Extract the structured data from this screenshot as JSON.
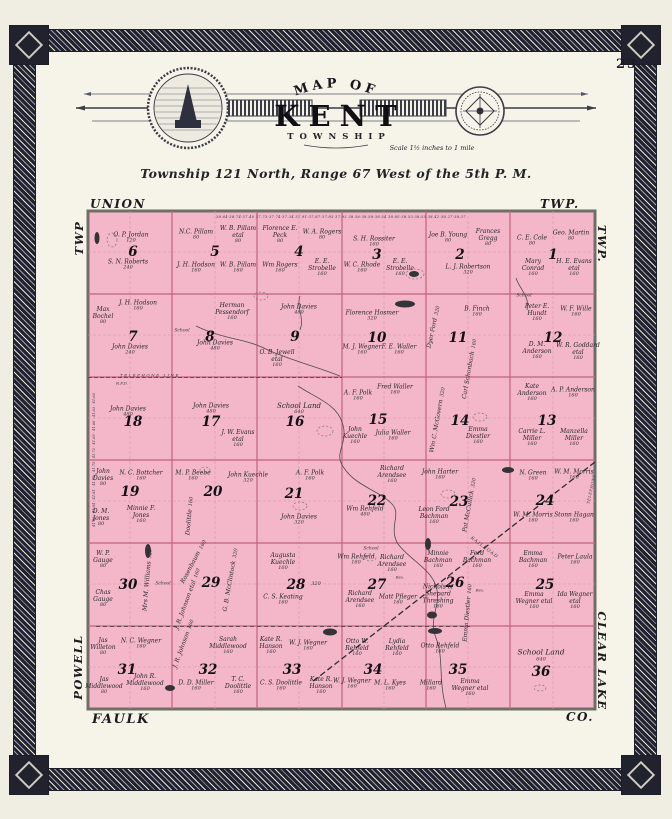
{
  "page": {
    "number": "23"
  },
  "banner": {
    "arc": "MAP OF",
    "title": "KENT",
    "subtitle": "TOWNSHIP",
    "scale": "Scale 1½ inches to 1 mile"
  },
  "township_line": "Township 121 North, Range 67 West of the 5th P. M.",
  "margins": {
    "top_left": "UNION",
    "top_right": "TWP.",
    "left_top": "TWP",
    "right_top": "TWP.",
    "left_bottom": "POWELL",
    "right_bottom": "CLEAR LAKE",
    "bottom_left": "FAULK",
    "bottom_right": "CO."
  },
  "colors": {
    "map_pink": "#f3b7c9",
    "grid_line": "#c2637c",
    "quarter_line": "#d795aa",
    "map_border": "#6f6f68",
    "paper": "#f6f3e9",
    "frame_dark": "#20222e"
  },
  "map": {
    "sections": [
      {
        "num": "6",
        "x": 133,
        "y": 252
      },
      {
        "num": "5",
        "x": 215,
        "y": 252
      },
      {
        "num": "4",
        "x": 299,
        "y": 252
      },
      {
        "num": "3",
        "x": 377,
        "y": 255
      },
      {
        "num": "2",
        "x": 460,
        "y": 255
      },
      {
        "num": "1",
        "x": 553,
        "y": 255
      },
      {
        "num": "7",
        "x": 133,
        "y": 337
      },
      {
        "num": "8",
        "x": 210,
        "y": 337
      },
      {
        "num": "9",
        "x": 295,
        "y": 337
      },
      {
        "num": "10",
        "x": 377,
        "y": 338
      },
      {
        "num": "11",
        "x": 458,
        "y": 338
      },
      {
        "num": "12",
        "x": 553,
        "y": 338
      },
      {
        "num": "18",
        "x": 133,
        "y": 422
      },
      {
        "num": "17",
        "x": 211,
        "y": 422
      },
      {
        "num": "16",
        "x": 295,
        "y": 422
      },
      {
        "num": "15",
        "x": 378,
        "y": 420
      },
      {
        "num": "14",
        "x": 460,
        "y": 421
      },
      {
        "num": "13",
        "x": 547,
        "y": 421
      },
      {
        "num": "19",
        "x": 130,
        "y": 492
      },
      {
        "num": "20",
        "x": 213,
        "y": 492
      },
      {
        "num": "21",
        "x": 294,
        "y": 494
      },
      {
        "num": "22",
        "x": 377,
        "y": 501
      },
      {
        "num": "23",
        "x": 459,
        "y": 502
      },
      {
        "num": "24",
        "x": 545,
        "y": 501
      },
      {
        "num": "30",
        "x": 128,
        "y": 585
      },
      {
        "num": "29",
        "x": 211,
        "y": 583
      },
      {
        "num": "28",
        "x": 296,
        "y": 585
      },
      {
        "num": "27",
        "x": 377,
        "y": 585
      },
      {
        "num": "26",
        "x": 455,
        "y": 583
      },
      {
        "num": "25",
        "x": 545,
        "y": 585
      },
      {
        "num": "31",
        "x": 127,
        "y": 670
      },
      {
        "num": "32",
        "x": 208,
        "y": 670
      },
      {
        "num": "33",
        "x": 292,
        "y": 670
      },
      {
        "num": "34",
        "x": 373,
        "y": 670
      },
      {
        "num": "35",
        "x": 458,
        "y": 670
      },
      {
        "num": "36",
        "x": 541,
        "y": 672
      }
    ],
    "parcels": [
      {
        "n": "O. P. Jordan",
        "a": "120",
        "x": 131,
        "y": 238,
        "w": 60
      },
      {
        "n": "S. N. Roberts",
        "a": "240",
        "x": 128,
        "y": 265,
        "w": 64
      },
      {
        "n": "N.C. Pillam",
        "a": "80",
        "x": 196,
        "y": 235,
        "w": 40
      },
      {
        "n": "W. B. Pillam etal",
        "a": "80",
        "x": 238,
        "y": 235,
        "w": 44
      },
      {
        "n": "J. H. Hodson",
        "a": "160",
        "x": 196,
        "y": 268,
        "w": 44
      },
      {
        "n": "W. B. Pillam",
        "a": "160",
        "x": 238,
        "y": 268,
        "w": 40
      },
      {
        "n": "Florence E. Peck",
        "a": "80",
        "x": 280,
        "y": 235,
        "w": 44
      },
      {
        "n": "W. A. Rogers",
        "a": "80",
        "x": 322,
        "y": 235,
        "w": 40
      },
      {
        "n": "Wm Rogers",
        "a": "160",
        "x": 280,
        "y": 268,
        "w": 40
      },
      {
        "n": "E. E. Strobelle",
        "a": "160",
        "x": 322,
        "y": 268,
        "w": 44
      },
      {
        "n": "S. H. Rossiter",
        "a": "160",
        "x": 374,
        "y": 242,
        "w": 64
      },
      {
        "n": "W. C. Rhode",
        "a": "160",
        "x": 362,
        "y": 268,
        "w": 40
      },
      {
        "n": "E. E. Strobelle",
        "a": "160",
        "x": 400,
        "y": 268,
        "w": 44
      },
      {
        "n": "Joe B. Young",
        "a": "80",
        "x": 448,
        "y": 238,
        "w": 40
      },
      {
        "n": "Frances Gregg",
        "a": "80",
        "x": 488,
        "y": 238,
        "w": 44
      },
      {
        "n": "L. J. Robertson",
        "a": "320",
        "x": 468,
        "y": 270,
        "w": 80
      },
      {
        "n": "C. E. Cole",
        "a": "80",
        "x": 532,
        "y": 241,
        "w": 40
      },
      {
        "n": "Geo. Martin",
        "a": "80",
        "x": 571,
        "y": 236,
        "w": 40
      },
      {
        "n": "Mary Conrad",
        "a": "160",
        "x": 533,
        "y": 268,
        "w": 40
      },
      {
        "n": "H. E. Evans etal",
        "a": "160",
        "x": 574,
        "y": 268,
        "w": 44
      },
      {
        "n": "Max Bochel",
        "a": "80",
        "x": 103,
        "y": 316,
        "w": 34
      },
      {
        "n": "J. H. Hodson",
        "a": "160",
        "x": 138,
        "y": 306,
        "w": 44
      },
      {
        "n": "John Davies",
        "a": "240",
        "x": 130,
        "y": 350,
        "w": 60
      },
      {
        "n": "Herman Pessendorf",
        "a": "160",
        "x": 232,
        "y": 312,
        "w": 60
      },
      {
        "n": "John Davies",
        "a": "480",
        "x": 215,
        "y": 346,
        "w": 60
      },
      {
        "n": "John Davies",
        "a": "480",
        "x": 299,
        "y": 310,
        "w": 60
      },
      {
        "n": "O. B. Jewell etal",
        "a": "160",
        "x": 277,
        "y": 359,
        "w": 40
      },
      {
        "n": "Florence Hosmer",
        "a": "320",
        "x": 372,
        "y": 316,
        "w": 80
      },
      {
        "n": "M. J. Wegner",
        "a": "160",
        "x": 362,
        "y": 350,
        "w": 40
      },
      {
        "n": "F. E. Waller",
        "a": "160",
        "x": 399,
        "y": 350,
        "w": 40
      },
      {
        "n": "Dyer Ford",
        "a": "320",
        "x": 434,
        "y": 327,
        "r": -78
      },
      {
        "n": "B. Finch",
        "a": "160",
        "x": 477,
        "y": 312,
        "w": 54
      },
      {
        "n": "Carl Schonbach",
        "a": "160",
        "x": 470,
        "y": 369,
        "r": -80
      },
      {
        "n": "Peter E. Hundt",
        "a": "160",
        "x": 537,
        "y": 313,
        "w": 44
      },
      {
        "n": "W. F. Wille",
        "a": "160",
        "x": 576,
        "y": 312,
        "w": 40
      },
      {
        "n": "D. M. Anderson",
        "a": "160",
        "x": 537,
        "y": 351,
        "w": 44
      },
      {
        "n": "W. R. Goddard etal",
        "a": "160",
        "x": 578,
        "y": 352,
        "w": 44
      },
      {
        "n": "John Davies",
        "a": "480",
        "x": 128,
        "y": 412,
        "w": 60
      },
      {
        "n": "John Davies",
        "a": "480",
        "x": 211,
        "y": 409,
        "w": 60
      },
      {
        "n": "J. W. Evans etal",
        "a": "160",
        "x": 238,
        "y": 439,
        "w": 44
      },
      {
        "n": "School Land",
        "a": "640",
        "x": 299,
        "y": 409,
        "w": 80,
        "fs": 7
      },
      {
        "n": "A. F. Polk",
        "a": "160",
        "x": 358,
        "y": 396,
        "w": 40
      },
      {
        "n": "Fred Waller",
        "a": "160",
        "x": 395,
        "y": 390,
        "w": 40
      },
      {
        "n": "John Kuechle",
        "a": "160",
        "x": 355,
        "y": 436,
        "w": 40
      },
      {
        "n": "Julia Waller",
        "a": "160",
        "x": 393,
        "y": 436,
        "w": 40
      },
      {
        "n": "Wm C. McGovern",
        "a": "320",
        "x": 438,
        "y": 420,
        "r": -80
      },
      {
        "n": "Emma Diestler",
        "a": "160",
        "x": 478,
        "y": 436,
        "w": 44
      },
      {
        "n": "Kate Anderson",
        "a": "160",
        "x": 532,
        "y": 393,
        "w": 44
      },
      {
        "n": "A. P. Anderson",
        "a": "160",
        "x": 573,
        "y": 393,
        "w": 44
      },
      {
        "n": "Carrie L. Miller",
        "a": "160",
        "x": 532,
        "y": 438,
        "w": 44
      },
      {
        "n": "Manzella Miller",
        "a": "160",
        "x": 574,
        "y": 438,
        "w": 44
      },
      {
        "n": "John Davies",
        "a": "80",
        "x": 103,
        "y": 478,
        "w": 34
      },
      {
        "n": "N. C. Bottcher",
        "a": "160",
        "x": 141,
        "y": 476,
        "w": 44
      },
      {
        "n": "D. M. Jones",
        "a": "80",
        "x": 101,
        "y": 518,
        "w": 34
      },
      {
        "n": "Minnie F. Jones",
        "a": "160",
        "x": 141,
        "y": 515,
        "w": 44
      },
      {
        "n": "M. P. Beebe",
        "a": "160",
        "x": 193,
        "y": 476,
        "w": 40
      },
      {
        "n": "John Kuechle",
        "a": "320",
        "x": 248,
        "y": 478,
        "w": 76
      },
      {
        "n": "Doolittle",
        "a": "160",
        "x": 190,
        "y": 516,
        "r": -85
      },
      {
        "n": "A. F. Polk",
        "a": "160",
        "x": 310,
        "y": 476,
        "w": 40
      },
      {
        "n": "John Davies",
        "a": "320",
        "x": 299,
        "y": 520,
        "w": 60
      },
      {
        "n": "Richard Arendsee",
        "a": "160",
        "x": 392,
        "y": 475,
        "w": 50
      },
      {
        "n": "Wm Rehfeld",
        "a": "480",
        "x": 365,
        "y": 512,
        "w": 60
      },
      {
        "n": "John Harter",
        "a": "160",
        "x": 440,
        "y": 475,
        "w": 40
      },
      {
        "n": "Leon Ford Bachman",
        "a": "160",
        "x": 434,
        "y": 516,
        "w": 40
      },
      {
        "n": "Pat McCullick",
        "a": "320",
        "x": 470,
        "y": 505,
        "r": -80
      },
      {
        "n": "N. Green",
        "a": "160",
        "x": 533,
        "y": 476,
        "w": 40
      },
      {
        "n": "W. M. Morris",
        "a": "160",
        "x": 574,
        "y": 475,
        "w": 40
      },
      {
        "n": "W. M. Morris",
        "a": "160",
        "x": 533,
        "y": 518,
        "w": 40
      },
      {
        "n": "Stonn Hagan",
        "a": "160",
        "x": 574,
        "y": 518,
        "w": 40
      },
      {
        "n": "W. P. Gauge",
        "a": "80",
        "x": 103,
        "y": 560,
        "w": 34
      },
      {
        "n": "Mrs M. Williams",
        "a": "320",
        "x": 148,
        "y": 580,
        "r": -85
      },
      {
        "n": "Chas Gauge",
        "a": "80",
        "x": 103,
        "y": 599,
        "w": 34
      },
      {
        "n": "Rosenbaum",
        "a": "160",
        "x": 194,
        "y": 562,
        "r": -62
      },
      {
        "n": "J. R. Johnson etal",
        "a": "160",
        "x": 188,
        "y": 599,
        "r": -70
      },
      {
        "n": "G. B. McClintock",
        "a": "320",
        "x": 231,
        "y": 580,
        "r": -80
      },
      {
        "n": "Augusta Kuechle",
        "a": "160",
        "x": 283,
        "y": 562,
        "w": 50
      },
      {
        "n": "C. S. Keating",
        "a": "160",
        "x": 283,
        "y": 600,
        "w": 44
      },
      {
        "n": "",
        "a": "320",
        "x": 316,
        "y": 585
      },
      {
        "n": "Wm Rehfeld",
        "a": "160",
        "x": 356,
        "y": 560,
        "w": 60
      },
      {
        "n": "Richard Arendsee",
        "a": "160",
        "x": 392,
        "y": 564,
        "w": 44
      },
      {
        "n": "Richard Arendsee",
        "a": "160",
        "x": 360,
        "y": 600,
        "w": 44
      },
      {
        "n": "Matt Pfleger",
        "a": "160",
        "x": 398,
        "y": 600,
        "w": 40
      },
      {
        "n": "Minnie Bachman",
        "a": "160",
        "x": 438,
        "y": 560,
        "w": 44
      },
      {
        "n": "Ferd Bachman",
        "a": "160",
        "x": 477,
        "y": 560,
        "w": 44
      },
      {
        "n": "Nichols & Shepard Threshing",
        "a": "160",
        "x": 438,
        "y": 597,
        "w": 46
      },
      {
        "n": "Emma Diestler",
        "a": "160",
        "x": 468,
        "y": 613,
        "r": -85
      },
      {
        "n": "Emma Bachman",
        "a": "160",
        "x": 533,
        "y": 560,
        "w": 44
      },
      {
        "n": "Peter Laula",
        "a": "160",
        "x": 575,
        "y": 560,
        "w": 40
      },
      {
        "n": "Emma Wegner etal",
        "a": "160",
        "x": 534,
        "y": 601,
        "w": 40
      },
      {
        "n": "Ida Wegner etal",
        "a": "160",
        "x": 575,
        "y": 601,
        "w": 40
      },
      {
        "n": "Jas Willeton",
        "a": "80",
        "x": 103,
        "y": 647,
        "w": 34
      },
      {
        "n": "N. C. Wegner",
        "a": "160",
        "x": 141,
        "y": 644,
        "w": 44
      },
      {
        "n": "Jas Middlewood",
        "a": "80",
        "x": 104,
        "y": 686,
        "w": 40
      },
      {
        "n": "John R. Middlewood",
        "a": "160",
        "x": 145,
        "y": 683,
        "w": 56
      },
      {
        "n": "J. R. Johnson",
        "a": "160",
        "x": 184,
        "y": 644,
        "r": -70
      },
      {
        "n": "Sarah Middlewood",
        "a": "160",
        "x": 228,
        "y": 646,
        "w": 50
      },
      {
        "n": "D. D. Miller",
        "a": "160",
        "x": 196,
        "y": 686,
        "w": 40
      },
      {
        "n": "T. C. Doolittle",
        "a": "160",
        "x": 238,
        "y": 686,
        "w": 40
      },
      {
        "n": "Kate R. Hanson",
        "a": "160",
        "x": 271,
        "y": 646,
        "w": 44
      },
      {
        "n": "W. J. Wegner",
        "a": "160",
        "x": 308,
        "y": 646,
        "w": 40
      },
      {
        "n": "C. S. Doolittle",
        "a": "160",
        "x": 281,
        "y": 686,
        "w": 44
      },
      {
        "n": "Kate R. Hanson",
        "a": "160",
        "x": 321,
        "y": 686,
        "w": 44
      },
      {
        "n": "Otto W. Rehfeld",
        "a": "160",
        "x": 357,
        "y": 648,
        "w": 40
      },
      {
        "n": "Lydia Rehfeld",
        "a": "160",
        "x": 397,
        "y": 648,
        "w": 40
      },
      {
        "n": "W. J. Wegner",
        "a": "160",
        "x": 352,
        "y": 684,
        "w": 40
      },
      {
        "n": "M. L. Kyes",
        "a": "160",
        "x": 390,
        "y": 686,
        "w": 40
      },
      {
        "n": "Otto Rehfeld",
        "a": "160",
        "x": 440,
        "y": 649,
        "w": 40
      },
      {
        "n": "Millard",
        "a": "160",
        "x": 431,
        "y": 686,
        "w": 40
      },
      {
        "n": "Emma Wegner etal",
        "a": "160",
        "x": 470,
        "y": 688,
        "w": 40
      },
      {
        "n": "School Land",
        "a": "640",
        "x": 541,
        "y": 656,
        "w": 90,
        "fs": 7.5
      }
    ],
    "features": [
      {
        "text": "TELEPHONE LINE",
        "x": 150,
        "y": 375,
        "size": 4,
        "ls": 1.5
      },
      {
        "text": "R.F.D.",
        "x": 122,
        "y": 383,
        "size": 4
      },
      {
        "text": "School",
        "x": 182,
        "y": 331,
        "size": 4.5
      },
      {
        "text": "School",
        "x": 524,
        "y": 296,
        "size": 4.5
      },
      {
        "text": "School",
        "x": 163,
        "y": 584,
        "size": 4.5
      },
      {
        "text": "School",
        "x": 371,
        "y": 549,
        "size": 4.5
      },
      {
        "text": "Res.",
        "x": 400,
        "y": 577,
        "size": 4
      },
      {
        "text": "Res.",
        "x": 480,
        "y": 590,
        "size": 4
      },
      {
        "text": "RAILROAD",
        "x": 484,
        "y": 548,
        "size": 4.5,
        "rot": 37,
        "ls": 1
      },
      {
        "text": "TELEPHONE",
        "x": 591,
        "y": 489,
        "size": 3.8,
        "rot": -78,
        "ls": 0.5
      },
      {
        "text": "38.64·38.74·37.40    37.73·37.74·37.34    37.91·37.87·37.85·37.92    38.56·38.58·38.54    38.85·38.53·38.55    38.42·38.27·38.37",
        "x": 341,
        "y": 217,
        "size": 3.6,
        "ls": 0.3,
        "w": 500
      },
      {
        "text": "41.86 · 41.84 · 41.81 · 41.78 · 41.75 · 41.72 · 41.69 · 41.66 · 41.63 · 41.60",
        "x": 94,
        "y": 460,
        "size": 3.6,
        "rot": -90,
        "w": 480
      }
    ]
  }
}
